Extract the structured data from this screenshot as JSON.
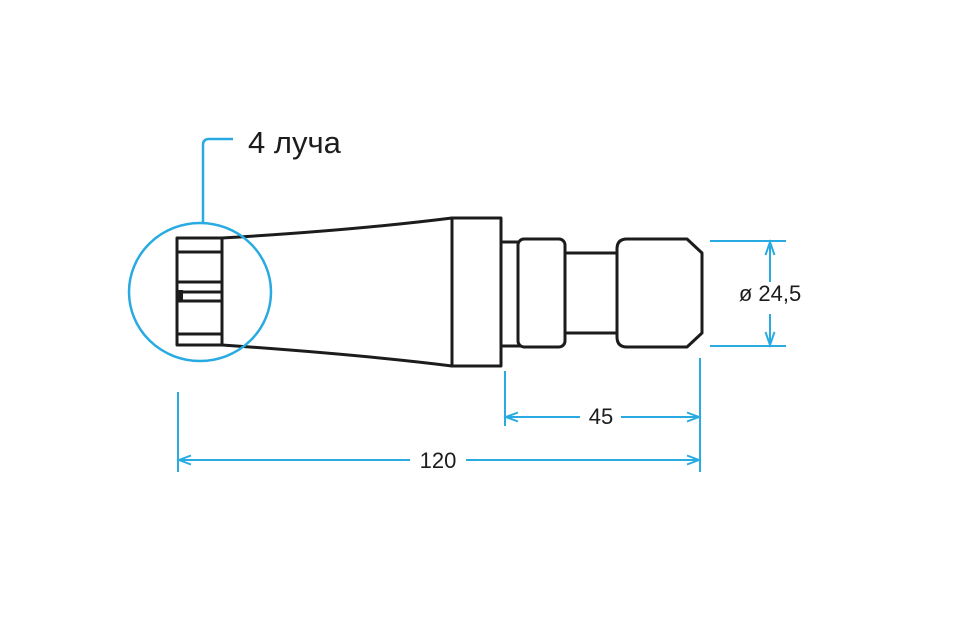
{
  "drawing": {
    "callout": {
      "label": "4 луча"
    },
    "dimensions": {
      "diameter": {
        "label": "ø 24,5"
      },
      "front_section_length": {
        "label": "45"
      },
      "overall_length": {
        "label": "120"
      }
    },
    "colors": {
      "accent_blue": "#29ABE2",
      "line_black": "#1C1C1C",
      "background": "#FFFFFF"
    }
  }
}
